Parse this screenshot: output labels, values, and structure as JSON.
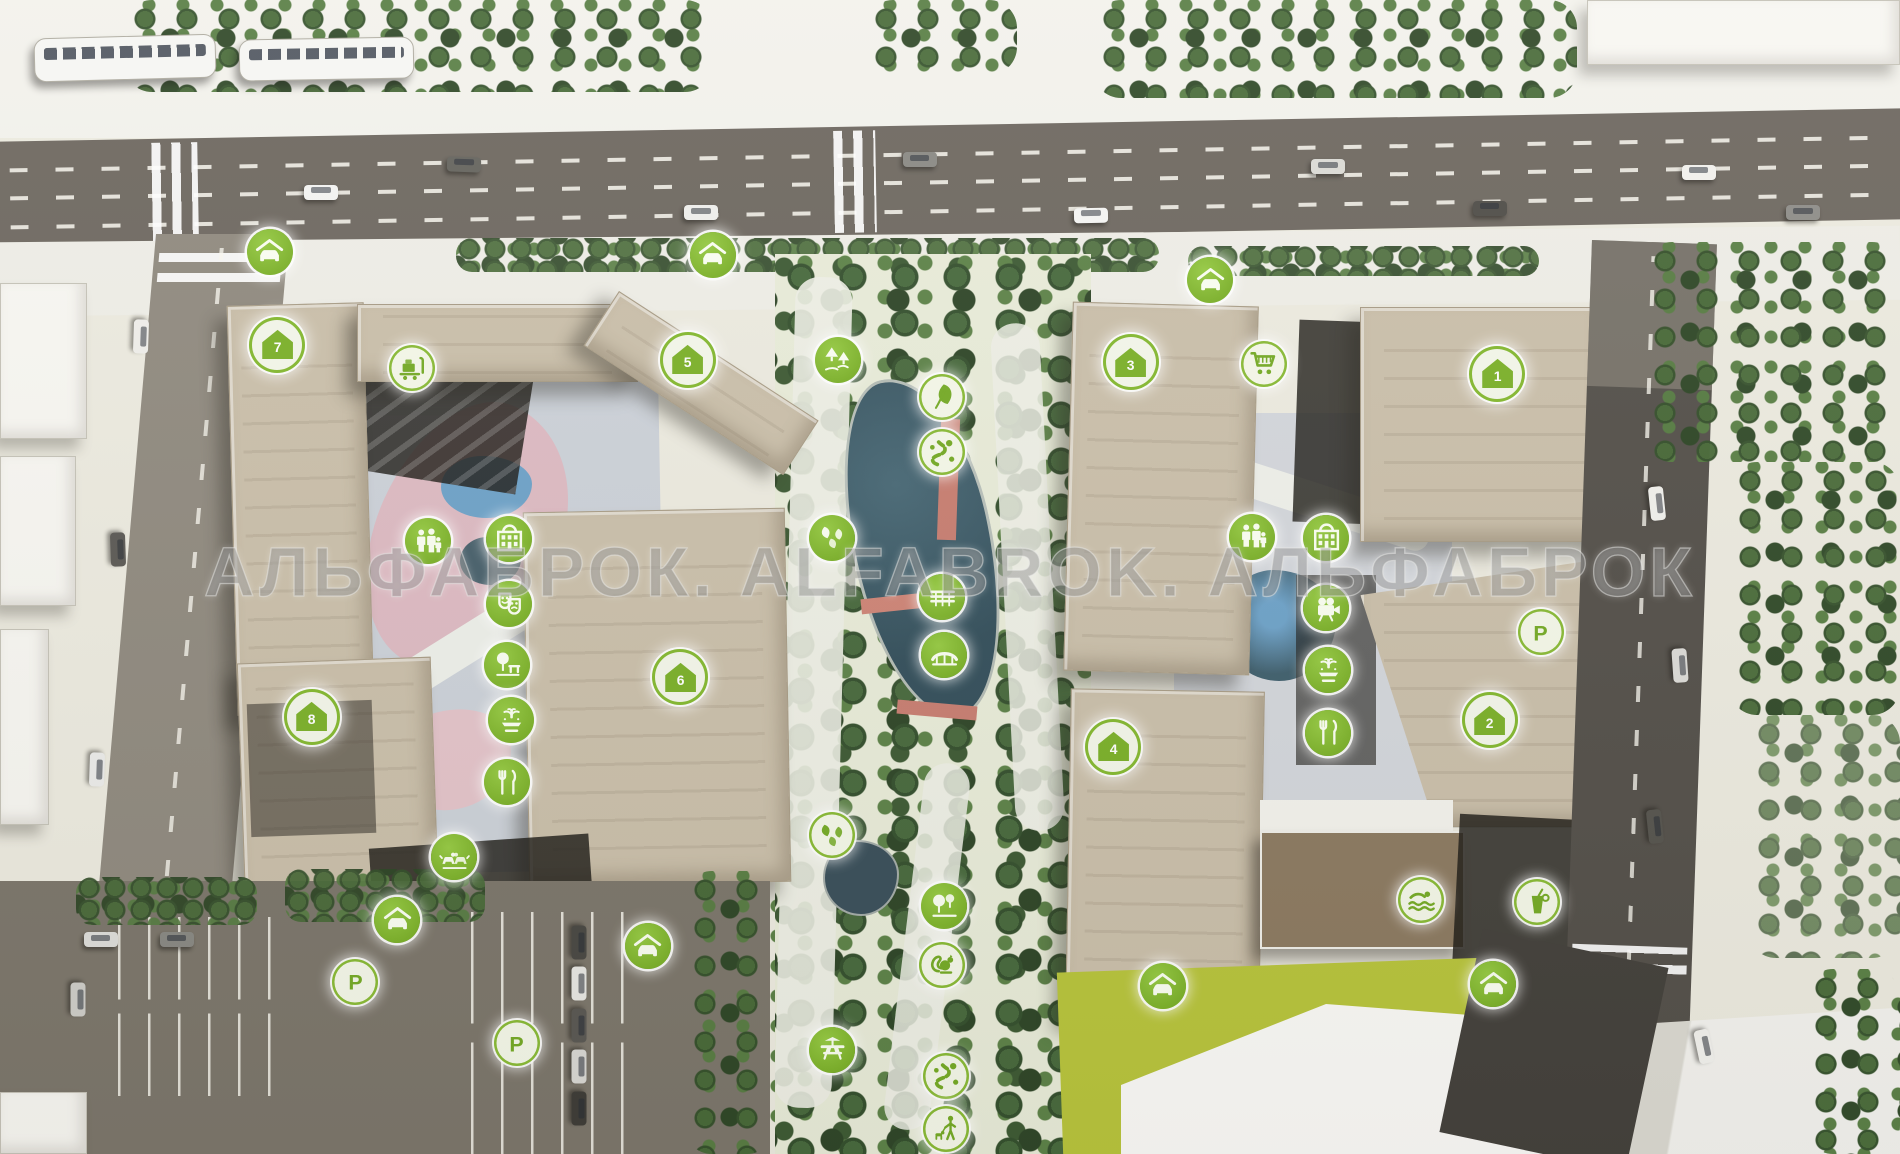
{
  "watermark": {
    "text": "АЛЬФАБРОК. ALFABROK. АЛЬФАБРОК"
  },
  "palette": {
    "marker_green": "#7cb12a",
    "marker_glyph_light": "#76ab27",
    "road": "#6f6961",
    "building_beige": "#cbc0ab",
    "pond": "#3e5a68",
    "lawn": "#b9c53d",
    "tree_dark": "#2e4726"
  },
  "markers": [
    {
      "icon": "covered-parking",
      "variant": "green",
      "x": 14.2,
      "y": 21.8
    },
    {
      "icon": "covered-parking",
      "variant": "green",
      "x": 37.5,
      "y": 22.1
    },
    {
      "icon": "covered-parking",
      "variant": "green",
      "x": 63.7,
      "y": 24.3
    },
    {
      "icon": "house",
      "label": "7",
      "variant": "house",
      "x": 14.6,
      "y": 29.9
    },
    {
      "icon": "house",
      "label": "5",
      "variant": "house",
      "x": 36.2,
      "y": 31.2
    },
    {
      "icon": "house",
      "label": "3",
      "variant": "house",
      "x": 59.5,
      "y": 31.4
    },
    {
      "icon": "house",
      "label": "1",
      "variant": "house",
      "x": 78.8,
      "y": 32.4
    },
    {
      "icon": "house",
      "label": "8",
      "variant": "house",
      "x": 16.4,
      "y": 62.1
    },
    {
      "icon": "house",
      "label": "6",
      "variant": "house",
      "x": 35.8,
      "y": 58.7
    },
    {
      "icon": "house",
      "label": "4",
      "variant": "house",
      "x": 58.6,
      "y": 64.7
    },
    {
      "icon": "house",
      "label": "2",
      "variant": "house",
      "x": 78.4,
      "y": 62.4
    },
    {
      "icon": "luggage-trolley",
      "variant": "light",
      "x": 21.7,
      "y": 31.9
    },
    {
      "icon": "family",
      "variant": "green",
      "x": 22.5,
      "y": 46.9
    },
    {
      "icon": "kindergarten",
      "variant": "green",
      "x": 26.8,
      "y": 46.7
    },
    {
      "icon": "theater-masks",
      "variant": "green",
      "x": 26.8,
      "y": 52.3
    },
    {
      "icon": "tree-bench",
      "variant": "green",
      "x": 26.7,
      "y": 57.6
    },
    {
      "icon": "fountain",
      "variant": "green",
      "x": 26.9,
      "y": 62.4
    },
    {
      "icon": "restaurant",
      "variant": "green",
      "x": 26.7,
      "y": 67.8
    },
    {
      "icon": "dog-park",
      "variant": "green",
      "x": 23.9,
      "y": 74.3
    },
    {
      "icon": "covered-parking",
      "variant": "green",
      "x": 20.9,
      "y": 79.7
    },
    {
      "icon": "parking",
      "label": "P",
      "variant": "light",
      "x": 18.7,
      "y": 85.1
    },
    {
      "icon": "parking",
      "label": "P",
      "variant": "light",
      "x": 27.2,
      "y": 90.4
    },
    {
      "icon": "covered-parking",
      "variant": "green",
      "x": 34.1,
      "y": 82.0
    },
    {
      "icon": "forest",
      "variant": "green",
      "x": 44.1,
      "y": 31.2
    },
    {
      "icon": "leaf",
      "variant": "light",
      "x": 49.6,
      "y": 34.4
    },
    {
      "icon": "trail",
      "variant": "light",
      "x": 49.6,
      "y": 39.2
    },
    {
      "icon": "leaves",
      "variant": "green",
      "x": 43.8,
      "y": 46.6
    },
    {
      "icon": "pier",
      "variant": "green",
      "x": 49.6,
      "y": 51.7
    },
    {
      "icon": "bridge",
      "variant": "green",
      "x": 49.7,
      "y": 56.8
    },
    {
      "icon": "leaves",
      "variant": "light",
      "x": 43.8,
      "y": 72.4
    },
    {
      "icon": "grove",
      "variant": "green",
      "x": 49.7,
      "y": 78.5
    },
    {
      "icon": "squirrel",
      "variant": "light",
      "x": 49.6,
      "y": 83.6
    },
    {
      "icon": "picnic",
      "variant": "green",
      "x": 43.8,
      "y": 91.0
    },
    {
      "icon": "trail",
      "variant": "light",
      "x": 49.8,
      "y": 93.2
    },
    {
      "icon": "dog-walk",
      "variant": "light",
      "x": 49.8,
      "y": 97.8
    },
    {
      "icon": "shopping-cart",
      "variant": "light",
      "x": 66.5,
      "y": 31.5
    },
    {
      "icon": "family",
      "variant": "green",
      "x": 65.9,
      "y": 46.5
    },
    {
      "icon": "kindergarten",
      "variant": "green",
      "x": 69.8,
      "y": 46.6
    },
    {
      "icon": "cinema",
      "variant": "green",
      "x": 69.8,
      "y": 52.7
    },
    {
      "icon": "fountain",
      "variant": "green",
      "x": 69.9,
      "y": 58.1
    },
    {
      "icon": "restaurant",
      "variant": "green",
      "x": 69.9,
      "y": 63.5
    },
    {
      "icon": "parking",
      "label": "P",
      "variant": "light",
      "x": 81.1,
      "y": 54.8
    },
    {
      "icon": "swimmer",
      "variant": "light",
      "x": 74.8,
      "y": 78.0
    },
    {
      "icon": "drink",
      "variant": "light",
      "x": 80.9,
      "y": 78.2
    },
    {
      "icon": "covered-parking",
      "variant": "green",
      "x": 61.2,
      "y": 85.4
    },
    {
      "icon": "covered-parking",
      "variant": "green",
      "x": 78.6,
      "y": 85.3
    }
  ]
}
